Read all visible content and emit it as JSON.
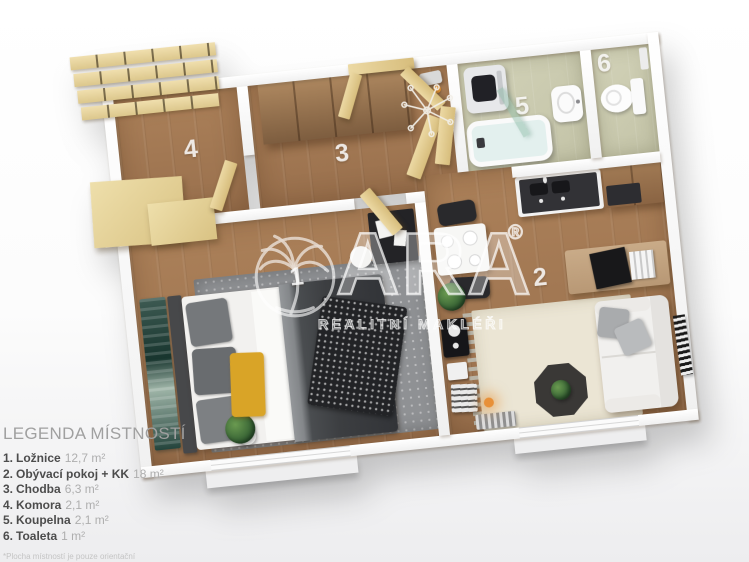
{
  "legend": {
    "title": "LEGENDA MÍSTNOSTÍ",
    "items": [
      {
        "number": "1.",
        "name": "Ložnice",
        "area": "12,7 m²"
      },
      {
        "number": "2.",
        "name": "Obývací pokoj + KK",
        "area": "18 m²"
      },
      {
        "number": "3.",
        "name": "Chodba",
        "area": "6,3 m²"
      },
      {
        "number": "4.",
        "name": "Komora",
        "area": "2,1 m²"
      },
      {
        "number": "5.",
        "name": "Koupelna",
        "area": "2,1 m²"
      },
      {
        "number": "6.",
        "name": "Toaleta",
        "area": "1 m²"
      }
    ],
    "note": "*Plocha místností je pouze orientační"
  },
  "watermark": {
    "brand": "ARA",
    "registered": "®",
    "tagline": "REALITNÍ MAKLÉŘI"
  },
  "floor_plan": {
    "labels": {
      "bedroom": "1",
      "living_room": "2",
      "hallway": "3",
      "storage": "4",
      "bathroom": "5",
      "toilet": "6"
    }
  },
  "colors": {
    "wood_floor": "#a07a55",
    "bathroom_floor": "#cbcbb0",
    "wall": "#ffffff",
    "accent_pillow_yellow": "#d9a427",
    "light_wood_doors": "#e6d2a0",
    "dark_wood_wardrobe": "#94704e",
    "sofa": "#f1f0ee",
    "rug_cream": "#ebe5d4",
    "rug_gray": "#8f9194",
    "lamp_glow_orange": "#e89038",
    "watermark": "rgba(255,255,255,0.6)"
  }
}
